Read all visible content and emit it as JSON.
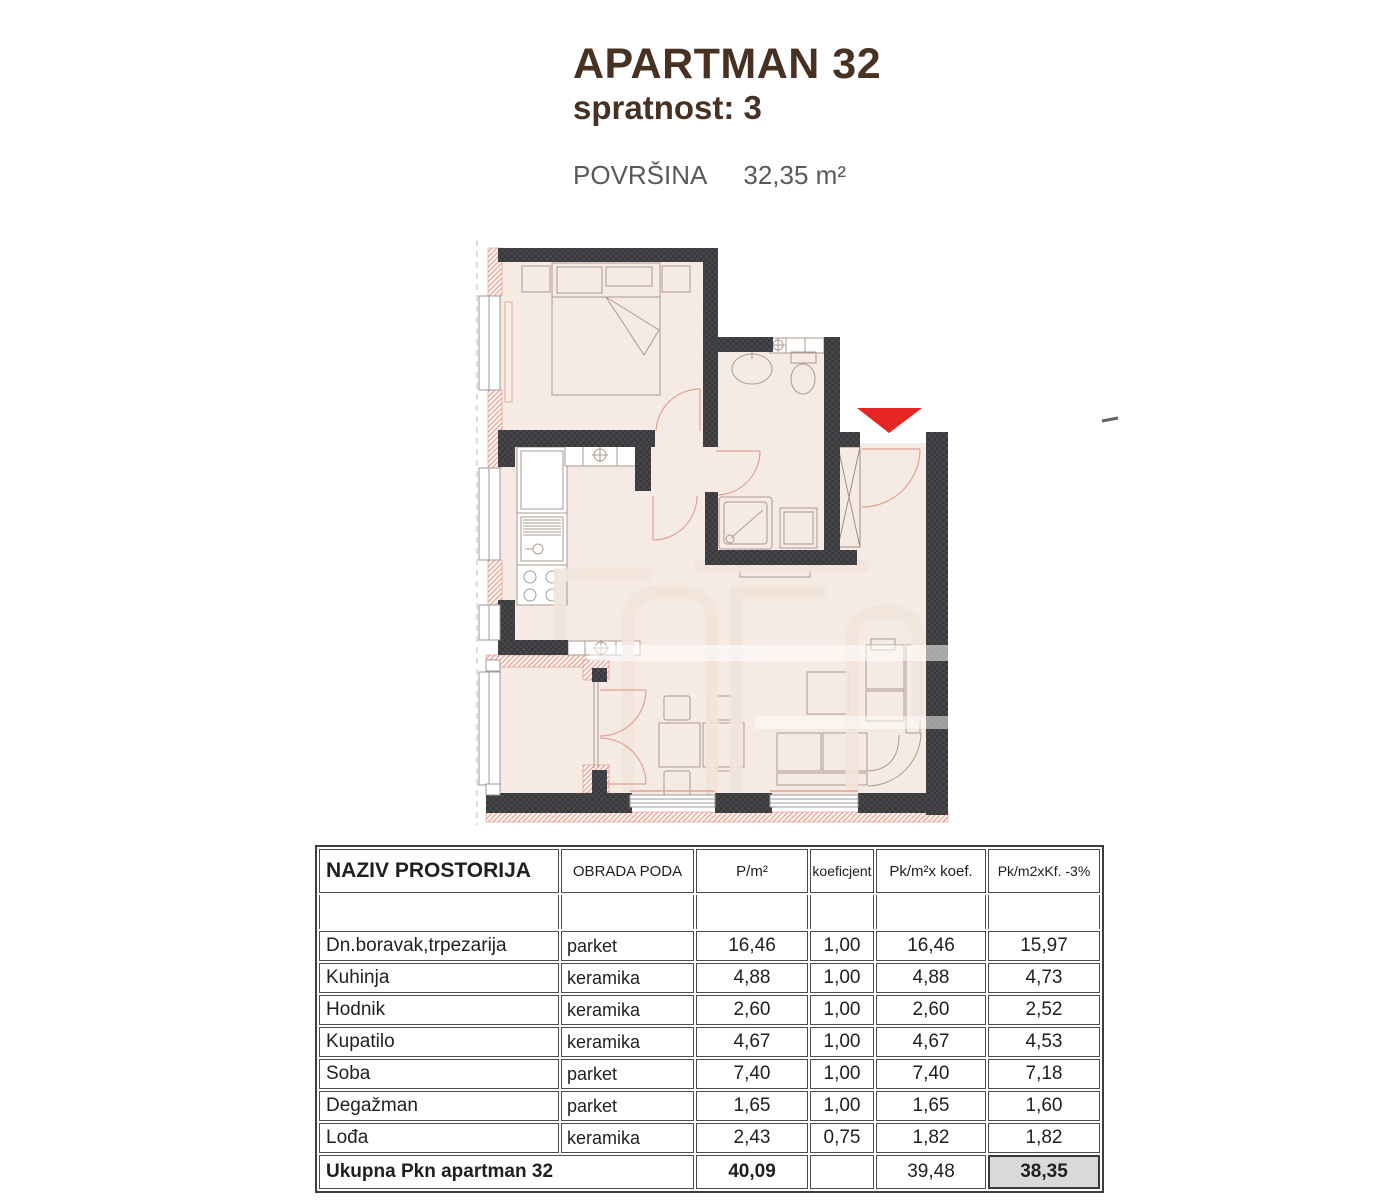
{
  "header": {
    "title": "APARTMAN 32",
    "floor_label": "spratnost: 3",
    "area_label": "POVRŠINA",
    "area_value": "32,35 m²"
  },
  "floor_plan": {
    "entrance_marker": "red-triangle-down",
    "colors": {
      "wall": "#3a3a3d",
      "room_fill": "#f6ebe4",
      "hatch_pink": "#e59c8f",
      "door_arc": "#dfa396",
      "entrance_red": "#e42522",
      "furniture_line": "#ab9a91",
      "title_brown": "#473122",
      "muted_text": "#58595b",
      "total_highlight": "#d9d9d9"
    }
  },
  "table": {
    "columns": [
      "NAZIV PROSTORIJA",
      "OBRADA PODA",
      "P/m²",
      "koeficjent",
      "Pk/m²x koef.",
      "Pk/m2xKf. -3%"
    ],
    "rows": [
      {
        "naziv": "Dn.boravak,trpezarija",
        "obrada": "parket",
        "p": "16,46",
        "koef": "1,00",
        "pk": "16,46",
        "pk3": "15,97"
      },
      {
        "naziv": "Kuhinja",
        "obrada": "keramika",
        "p": "4,88",
        "koef": "1,00",
        "pk": "4,88",
        "pk3": "4,73"
      },
      {
        "naziv": "Hodnik",
        "obrada": "keramika",
        "p": "2,60",
        "koef": "1,00",
        "pk": "2,60",
        "pk3": "2,52"
      },
      {
        "naziv": "Kupatilo",
        "obrada": "keramika",
        "p": "4,67",
        "koef": "1,00",
        "pk": "4,67",
        "pk3": "4,53"
      },
      {
        "naziv": "Soba",
        "obrada": "parket",
        "p": "7,40",
        "koef": "1,00",
        "pk": "7,40",
        "pk3": "7,18"
      },
      {
        "naziv": "Degažman",
        "obrada": "parket",
        "p": "1,65",
        "koef": "1,00",
        "pk": "1,65",
        "pk3": "1,60"
      },
      {
        "naziv": "Lođa",
        "obrada": "keramika",
        "p": "2,43",
        "koef": "0,75",
        "pk": "1,82",
        "pk3": "1,82"
      }
    ],
    "total": {
      "label": "Ukupna Pkn apartman 32",
      "p": "40,09",
      "koef": "",
      "pk": "39,48",
      "pk3": "38,35"
    }
  }
}
